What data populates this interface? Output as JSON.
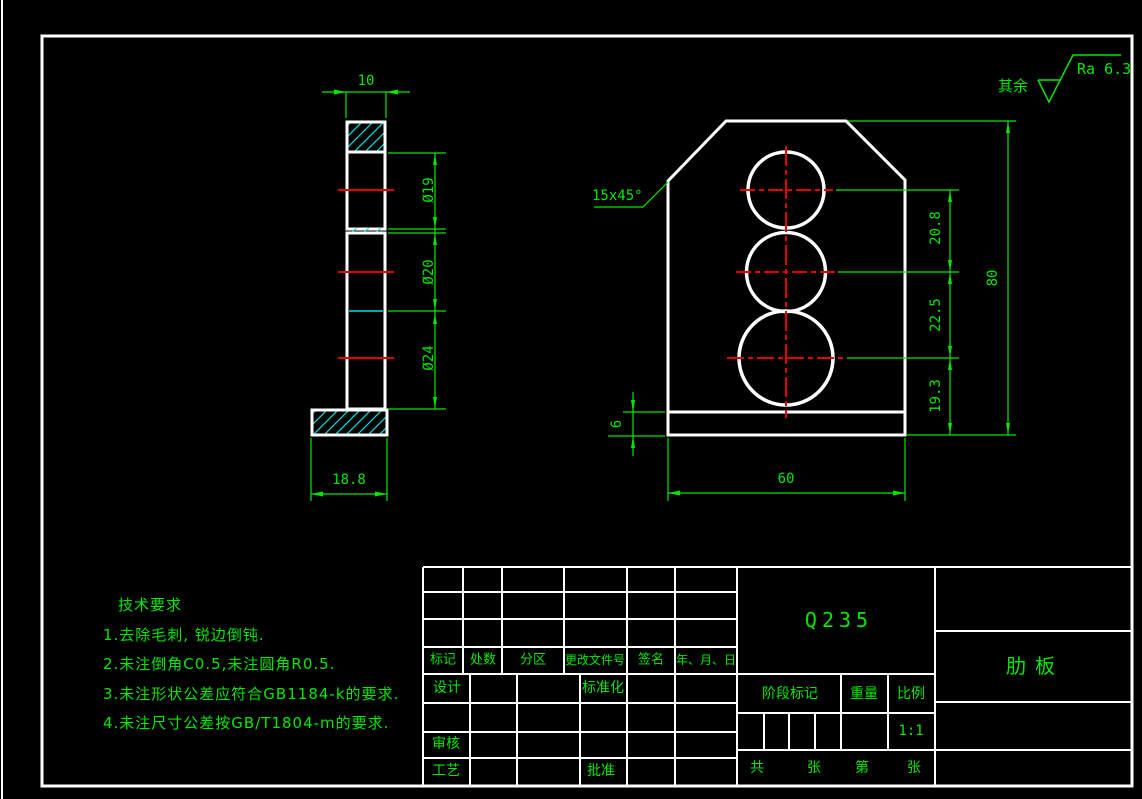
{
  "annotations": {
    "surface_prefix": "其余",
    "surface_value": "Ra 6.3",
    "chamfer": "15x45°"
  },
  "dims": {
    "top_width": "10",
    "side_base_width": "18.8",
    "d19": "Ø19",
    "d20": "Ø20",
    "d24": "Ø24",
    "h1": "20.8",
    "h2": "22.5",
    "h3": "19.3",
    "total_height": "80",
    "front_base_width": "60",
    "base_thickness": "6"
  },
  "tech": {
    "title": "技术要求",
    "items": [
      "1.去除毛刺, 锐边倒钝.",
      "2.未注倒角C0.5,未注圆角R0.5.",
      "3.未注形状公差应符合GB1184-k的要求.",
      "4.未注尺寸公差按GB/T1804-m的要求."
    ]
  },
  "title_block": {
    "material": "Q235",
    "part_name": "肋板",
    "rev_headers": [
      "标记",
      "处数",
      "分区",
      "更改文件号",
      "签名",
      "年、月、日"
    ],
    "design": "设计",
    "standardization": "标准化",
    "review": "审核",
    "process": "工艺",
    "approve": "批准",
    "stage": "阶段标记",
    "weight": "重量",
    "scale": "比例",
    "scale_value": "1:1",
    "sheet": [
      "共",
      "张",
      "第",
      "张"
    ]
  },
  "colors": {
    "outline": "#ffffff",
    "dimension": "#00e800",
    "centerline": "#e80000",
    "hatch": "#00e0e0"
  }
}
